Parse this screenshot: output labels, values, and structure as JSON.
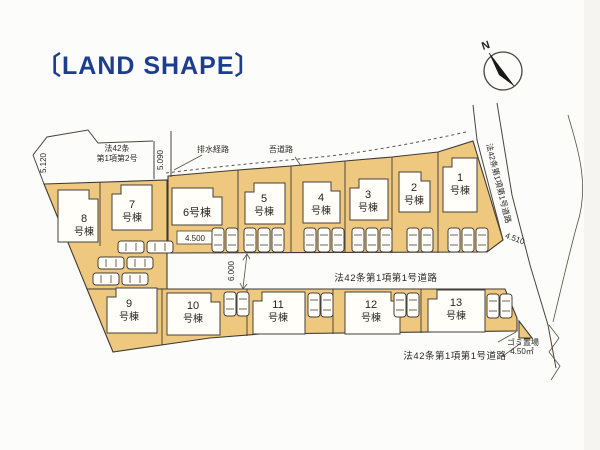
{
  "title": "〔LAND SHAPE〕",
  "compass": {
    "north": "N"
  },
  "road_labels": {
    "top_left_line1": "法42条",
    "top_left_line2": "第1項第2号",
    "top": "吾道路",
    "middle": "法42条第1項第1号道路",
    "right": "法42条第1項第1号道路",
    "bottom": "法42条第1項第1号道路"
  },
  "annotations": {
    "drainage_route": "排水経路",
    "garbage_area_line1": "ゴミ置場",
    "garbage_area_line2": "4.50㎡"
  },
  "dimensions": {
    "left_width": "5.120",
    "upper_width": "5.090",
    "driveway_width": "4.500",
    "road_width": "6.000",
    "right_width": "4.510"
  },
  "lots": [
    {
      "number": "1",
      "suffix": "号棟"
    },
    {
      "number": "2",
      "suffix": "号棟"
    },
    {
      "number": "3",
      "suffix": "号棟"
    },
    {
      "number": "4",
      "suffix": "号棟"
    },
    {
      "number": "5",
      "suffix": "号棟"
    },
    {
      "number": "6",
      "suffix": "号棟"
    },
    {
      "number": "7",
      "suffix": "号棟"
    },
    {
      "number": "8",
      "suffix": "号棟"
    },
    {
      "number": "9",
      "suffix": "号棟"
    },
    {
      "number": "10",
      "suffix": "号棟"
    },
    {
      "number": "11",
      "suffix": "号棟"
    },
    {
      "number": "12",
      "suffix": "号棟"
    },
    {
      "number": "13",
      "suffix": "号棟"
    }
  ],
  "colors": {
    "lot_fill": "#eec87f",
    "title": "#1d3d8e",
    "line": "#4a443c"
  }
}
